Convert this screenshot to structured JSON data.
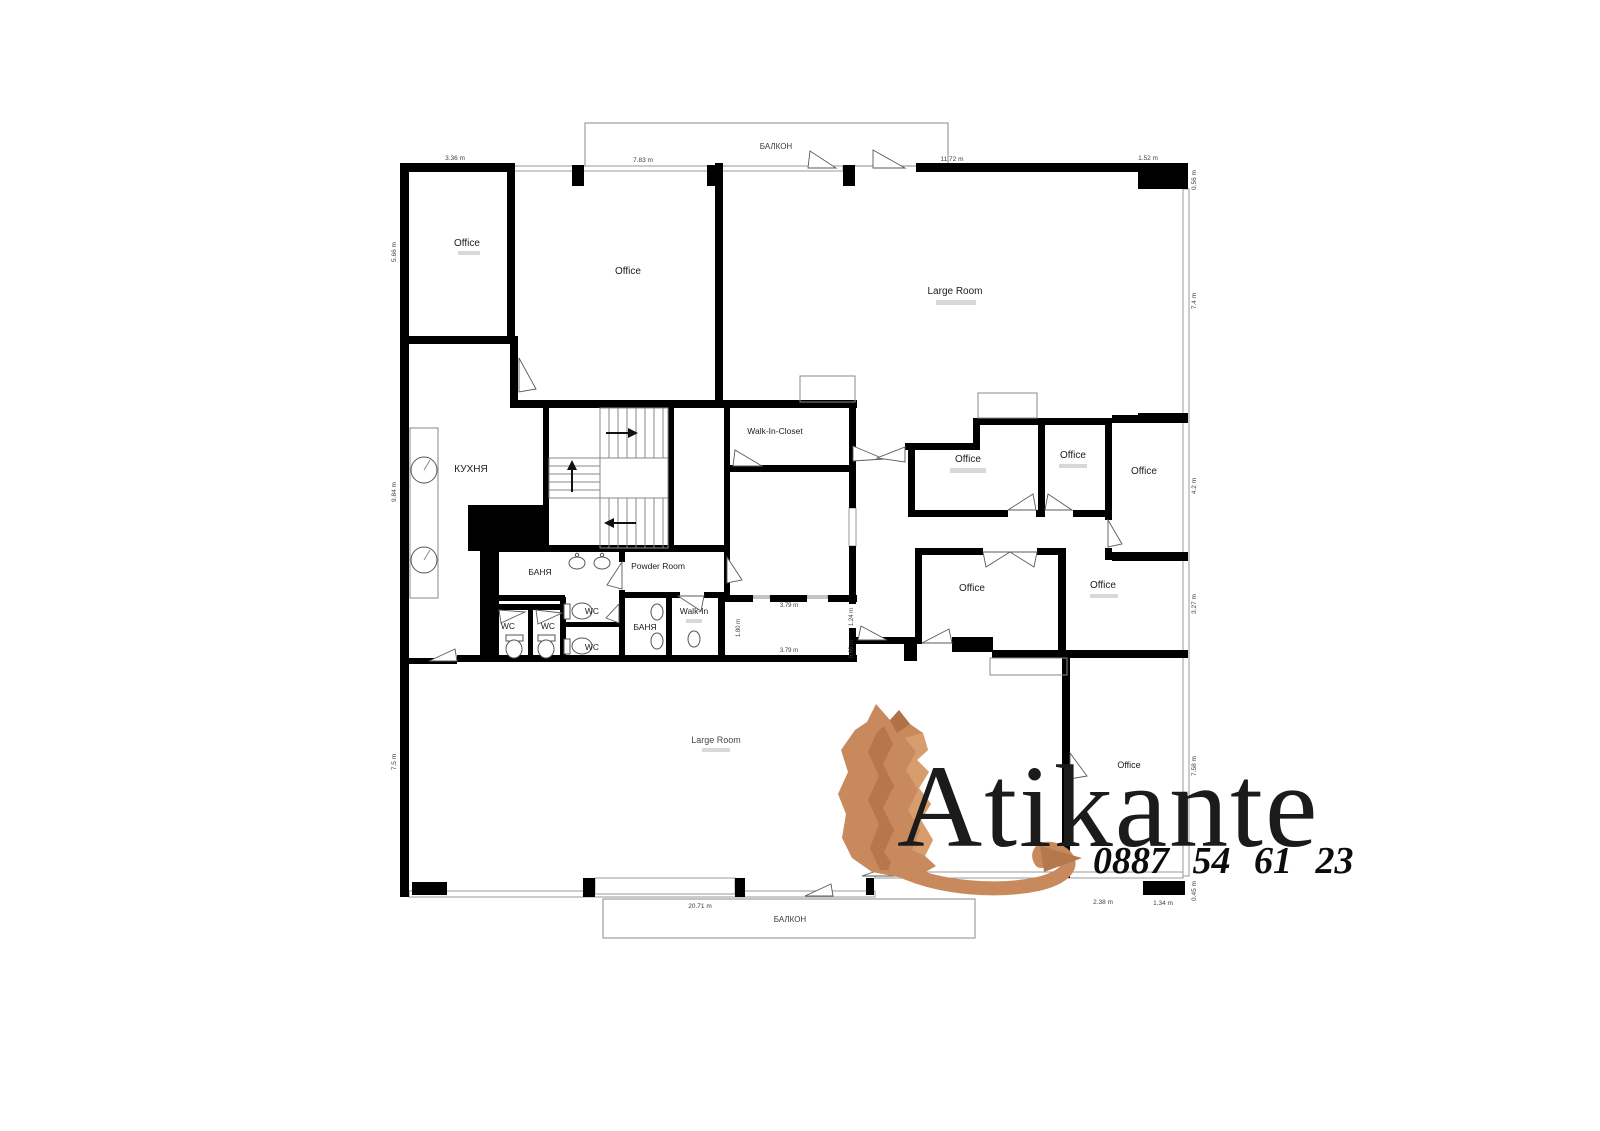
{
  "floor_plan": {
    "balconies": {
      "top": "БАЛКОН",
      "bottom": "БАЛКОН"
    },
    "rooms": {
      "office_top_left": "Office",
      "office_top_middle": "Office",
      "large_room": "Large Room",
      "kitchen": "КУХНЯ",
      "walk_in_closet": "Walk-In-Closet",
      "bathroom_1": "БАНЯ",
      "powder_room": "Powder Room",
      "wc_1": "WC",
      "wc_2": "WC",
      "wc_3": "WC",
      "wc_4": "WC",
      "bathroom_2": "БАНЯ",
      "walk_in_small": "Walk-In",
      "office_mid_left": "Office",
      "office_mid_center": "Office",
      "office_mid_right": "Office",
      "office_lower_left": "Office",
      "office_lower_right": "Office",
      "large_room_bottom": "Large Room",
      "office_bottom_right": "Office"
    },
    "dimensions": {
      "top_1": "3.36 m",
      "top_2": "7.83 m",
      "top_3": "11.72 m",
      "top_4": "1.52 m",
      "right_1": "0.56 m",
      "right_2": "7.4 m",
      "right_3": "4.2 m",
      "right_4": "3.27 m",
      "right_5": "7.58 m",
      "right_6": "0.45 m",
      "left_1": "5.66 m",
      "left_2": "9.84 m",
      "left_3": "7.5 m",
      "bottom_1": "20.71 m",
      "bottom_2": "2.38 m",
      "bottom_3": "1.34 m",
      "int_width_top": "3.79 m",
      "int_width_bottom": "3.79 m",
      "int_height": "1.80 m",
      "int_right_1": "1.24 m",
      "int_right_2": "0.66 m"
    }
  },
  "watermark": {
    "brand": "Atikante",
    "phone": "0887 54 61 23",
    "copper": "#c8895c",
    "copper_dark": "#a96a40",
    "text_color": "#1b1b1b"
  }
}
